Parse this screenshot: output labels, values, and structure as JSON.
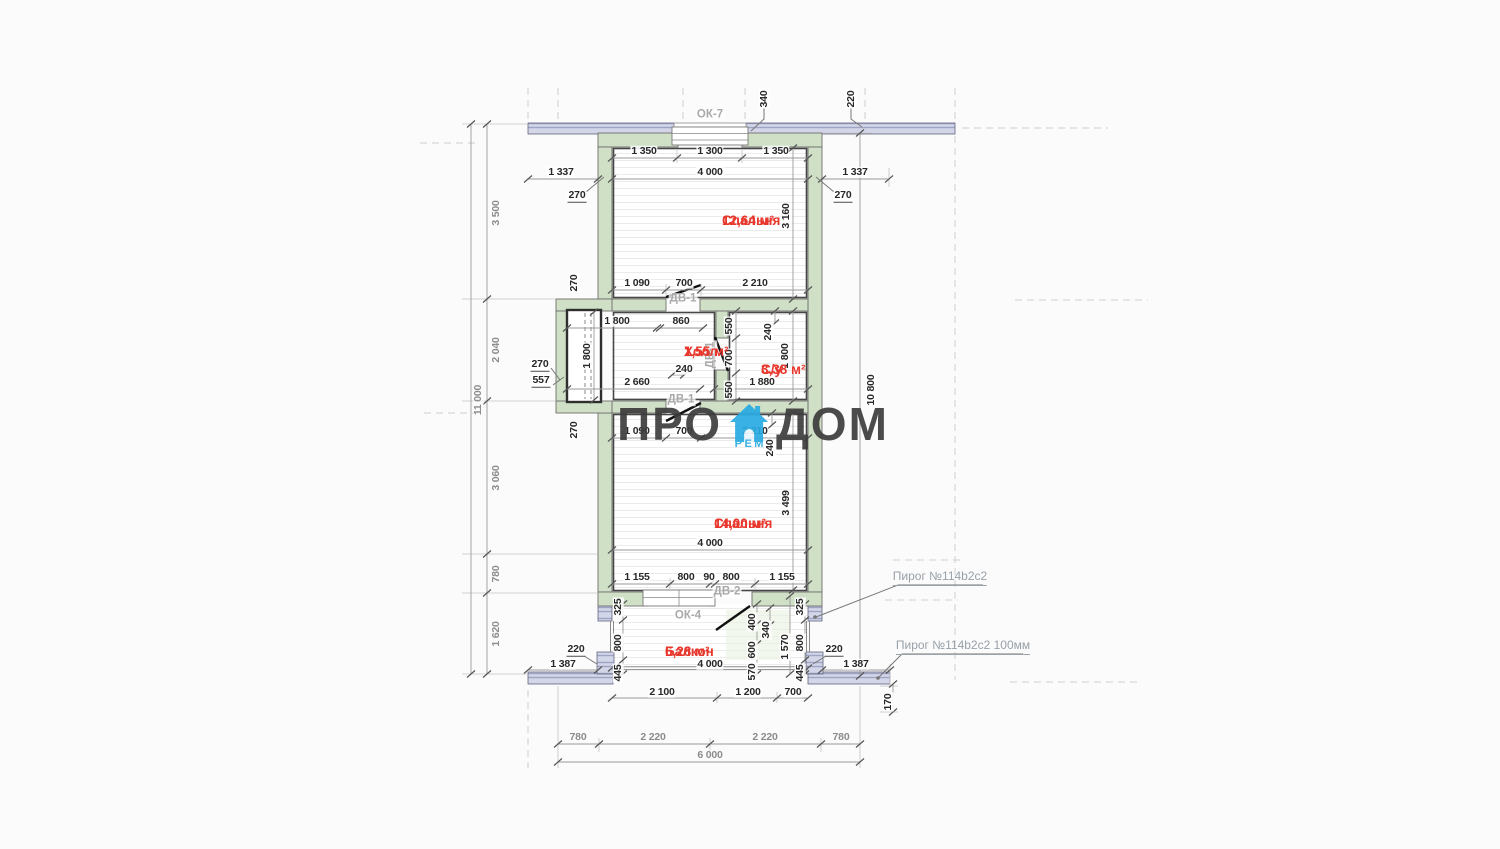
{
  "colors": {
    "wall_green": "#cfe0c6",
    "band_lavender": "#d3d6e8",
    "band_stripe": "#9fa3c4",
    "dim_dark": "#282828",
    "dim_gray": "#8c8c8c",
    "opening_label_gray": "#a9a9a9",
    "room_red": "#e8372c",
    "logo_gray": "#3d3d3d",
    "logo_blue": "#29abe2"
  },
  "watermark": {
    "left": "ПРО",
    "right": "ДОМ",
    "sub": "РЕМ"
  },
  "room_labels": [
    {
      "name": "Спальня",
      "area": "12,64 м²",
      "x": 722,
      "y": 212
    },
    {
      "name": "Холл",
      "area": "1,55 м²",
      "x": 684,
      "y": 343
    },
    {
      "name": "С/у",
      "area": "3,38 м²",
      "x": 761,
      "y": 361
    },
    {
      "name": "Спальня",
      "area": "14,00 м²",
      "x": 714,
      "y": 515
    },
    {
      "name": "Балкон",
      "area": "6,28 м²",
      "x": 665,
      "y": 643
    }
  ],
  "tag_labels": [
    {
      "t": "ОК-7",
      "x": 710,
      "y": 115
    },
    {
      "t": "ДВ-1",
      "x": 683,
      "y": 299
    },
    {
      "t": "ДВ-1",
      "x": 711,
      "y": 355,
      "r": 1
    },
    {
      "t": "ДВ-1",
      "x": 681,
      "y": 400
    },
    {
      "t": "ДВ-2",
      "x": 727,
      "y": 592
    },
    {
      "t": "ОК-4",
      "x": 688,
      "y": 616
    }
  ],
  "annotations": [
    {
      "text": "Пирог №114b2c2",
      "x": 940,
      "y": 578
    },
    {
      "text": "Пирог №114b2c2 100мм",
      "x": 963,
      "y": 647
    }
  ],
  "dim_labels": [
    {
      "t": "340",
      "x": 764,
      "y": 99,
      "r": 1
    },
    {
      "t": "220",
      "x": 851,
      "y": 99,
      "r": 1
    },
    {
      "t": "1 350",
      "x": 644,
      "y": 151
    },
    {
      "t": "1 300",
      "x": 710,
      "y": 151
    },
    {
      "t": "1 350",
      "x": 776,
      "y": 151
    },
    {
      "t": "1 337",
      "x": 561,
      "y": 172
    },
    {
      "t": "4 000",
      "x": 710,
      "y": 172
    },
    {
      "t": "1 337",
      "x": 855,
      "y": 172
    },
    {
      "t": "270",
      "x": 577,
      "y": 196,
      "u": 1
    },
    {
      "t": "270",
      "x": 843,
      "y": 196,
      "u": 1
    },
    {
      "t": "3 160",
      "x": 786,
      "y": 216,
      "r": 1
    },
    {
      "t": "270",
      "x": 574,
      "y": 283,
      "r": 1
    },
    {
      "t": "1 090",
      "x": 637,
      "y": 283
    },
    {
      "t": "700",
      "x": 684,
      "y": 283
    },
    {
      "t": "2 210",
      "x": 755,
      "y": 283
    },
    {
      "t": "1 800",
      "x": 617,
      "y": 321
    },
    {
      "t": "860",
      "x": 681,
      "y": 321
    },
    {
      "t": "550",
      "x": 729,
      "y": 326,
      "r": 1
    },
    {
      "t": "240",
      "x": 768,
      "y": 332,
      "r": 1
    },
    {
      "t": "1 800",
      "x": 587,
      "y": 356,
      "r": 1
    },
    {
      "t": "700",
      "x": 729,
      "y": 358,
      "r": 1
    },
    {
      "t": "1 800",
      "x": 785,
      "y": 356,
      "r": 1
    },
    {
      "t": "240",
      "x": 684,
      "y": 369
    },
    {
      "t": "270",
      "x": 540,
      "y": 365,
      "u": 1
    },
    {
      "t": "557",
      "x": 541,
      "y": 381,
      "u": 1
    },
    {
      "t": "2 660",
      "x": 637,
      "y": 382
    },
    {
      "t": "1 880",
      "x": 762,
      "y": 382
    },
    {
      "t": "550",
      "x": 729,
      "y": 390,
      "r": 1
    },
    {
      "t": "270",
      "x": 574,
      "y": 430,
      "r": 1
    },
    {
      "t": "1 090",
      "x": 637,
      "y": 431
    },
    {
      "t": "700",
      "x": 684,
      "y": 431
    },
    {
      "t": "2 210",
      "x": 755,
      "y": 431
    },
    {
      "t": "240",
      "x": 770,
      "y": 448,
      "r": 1
    },
    {
      "t": "3 499",
      "x": 786,
      "y": 503,
      "r": 1
    },
    {
      "t": "4 000",
      "x": 710,
      "y": 543
    },
    {
      "t": "1 155",
      "x": 637,
      "y": 577
    },
    {
      "t": "800",
      "x": 686,
      "y": 577
    },
    {
      "t": "90",
      "x": 709,
      "y": 577
    },
    {
      "t": "800",
      "x": 731,
      "y": 577
    },
    {
      "t": "1 155",
      "x": 782,
      "y": 577
    },
    {
      "t": "325",
      "x": 618,
      "y": 607,
      "r": 1
    },
    {
      "t": "325",
      "x": 800,
      "y": 607,
      "r": 1
    },
    {
      "t": "400",
      "x": 752,
      "y": 622,
      "r": 1
    },
    {
      "t": "340",
      "x": 766,
      "y": 630,
      "r": 1
    },
    {
      "t": "800",
      "x": 618,
      "y": 643,
      "r": 1
    },
    {
      "t": "800",
      "x": 800,
      "y": 643,
      "r": 1
    },
    {
      "t": "600",
      "x": 752,
      "y": 650,
      "r": 1
    },
    {
      "t": "1 570",
      "x": 785,
      "y": 647,
      "r": 1
    },
    {
      "t": "220",
      "x": 576,
      "y": 650,
      "u": 1
    },
    {
      "t": "220",
      "x": 834,
      "y": 650,
      "u": 1
    },
    {
      "t": "4 000",
      "x": 710,
      "y": 664
    },
    {
      "t": "570",
      "x": 752,
      "y": 672,
      "r": 1
    },
    {
      "t": "445",
      "x": 618,
      "y": 673,
      "r": 1
    },
    {
      "t": "445",
      "x": 800,
      "y": 673,
      "r": 1
    },
    {
      "t": "1 387",
      "x": 563,
      "y": 664
    },
    {
      "t": "1 387",
      "x": 856,
      "y": 664
    },
    {
      "t": "2 100",
      "x": 662,
      "y": 692
    },
    {
      "t": "1 200",
      "x": 748,
      "y": 692
    },
    {
      "t": "700",
      "x": 793,
      "y": 692
    },
    {
      "t": "170",
      "x": 888,
      "y": 702,
      "r": 1
    },
    {
      "t": "3 500",
      "x": 496,
      "y": 213,
      "r": 1,
      "c": "g"
    },
    {
      "t": "2 040",
      "x": 496,
      "y": 350,
      "r": 1,
      "c": "g"
    },
    {
      "t": "11 000",
      "x": 478,
      "y": 400,
      "r": 1,
      "c": "g"
    },
    {
      "t": "3 060",
      "x": 496,
      "y": 478,
      "r": 1,
      "c": "g"
    },
    {
      "t": "780",
      "x": 496,
      "y": 574,
      "r": 1,
      "c": "g"
    },
    {
      "t": "1 620",
      "x": 496,
      "y": 634,
      "r": 1,
      "c": "g"
    },
    {
      "t": "10 800",
      "x": 871,
      "y": 390,
      "r": 1
    },
    {
      "t": "780",
      "x": 578,
      "y": 737,
      "c": "g"
    },
    {
      "t": "2 220",
      "x": 653,
      "y": 737,
      "c": "g"
    },
    {
      "t": "2 220",
      "x": 765,
      "y": 737,
      "c": "g"
    },
    {
      "t": "780",
      "x": 841,
      "y": 737,
      "c": "g"
    },
    {
      "t": "6 000",
      "x": 710,
      "y": 755,
      "c": "g"
    }
  ]
}
